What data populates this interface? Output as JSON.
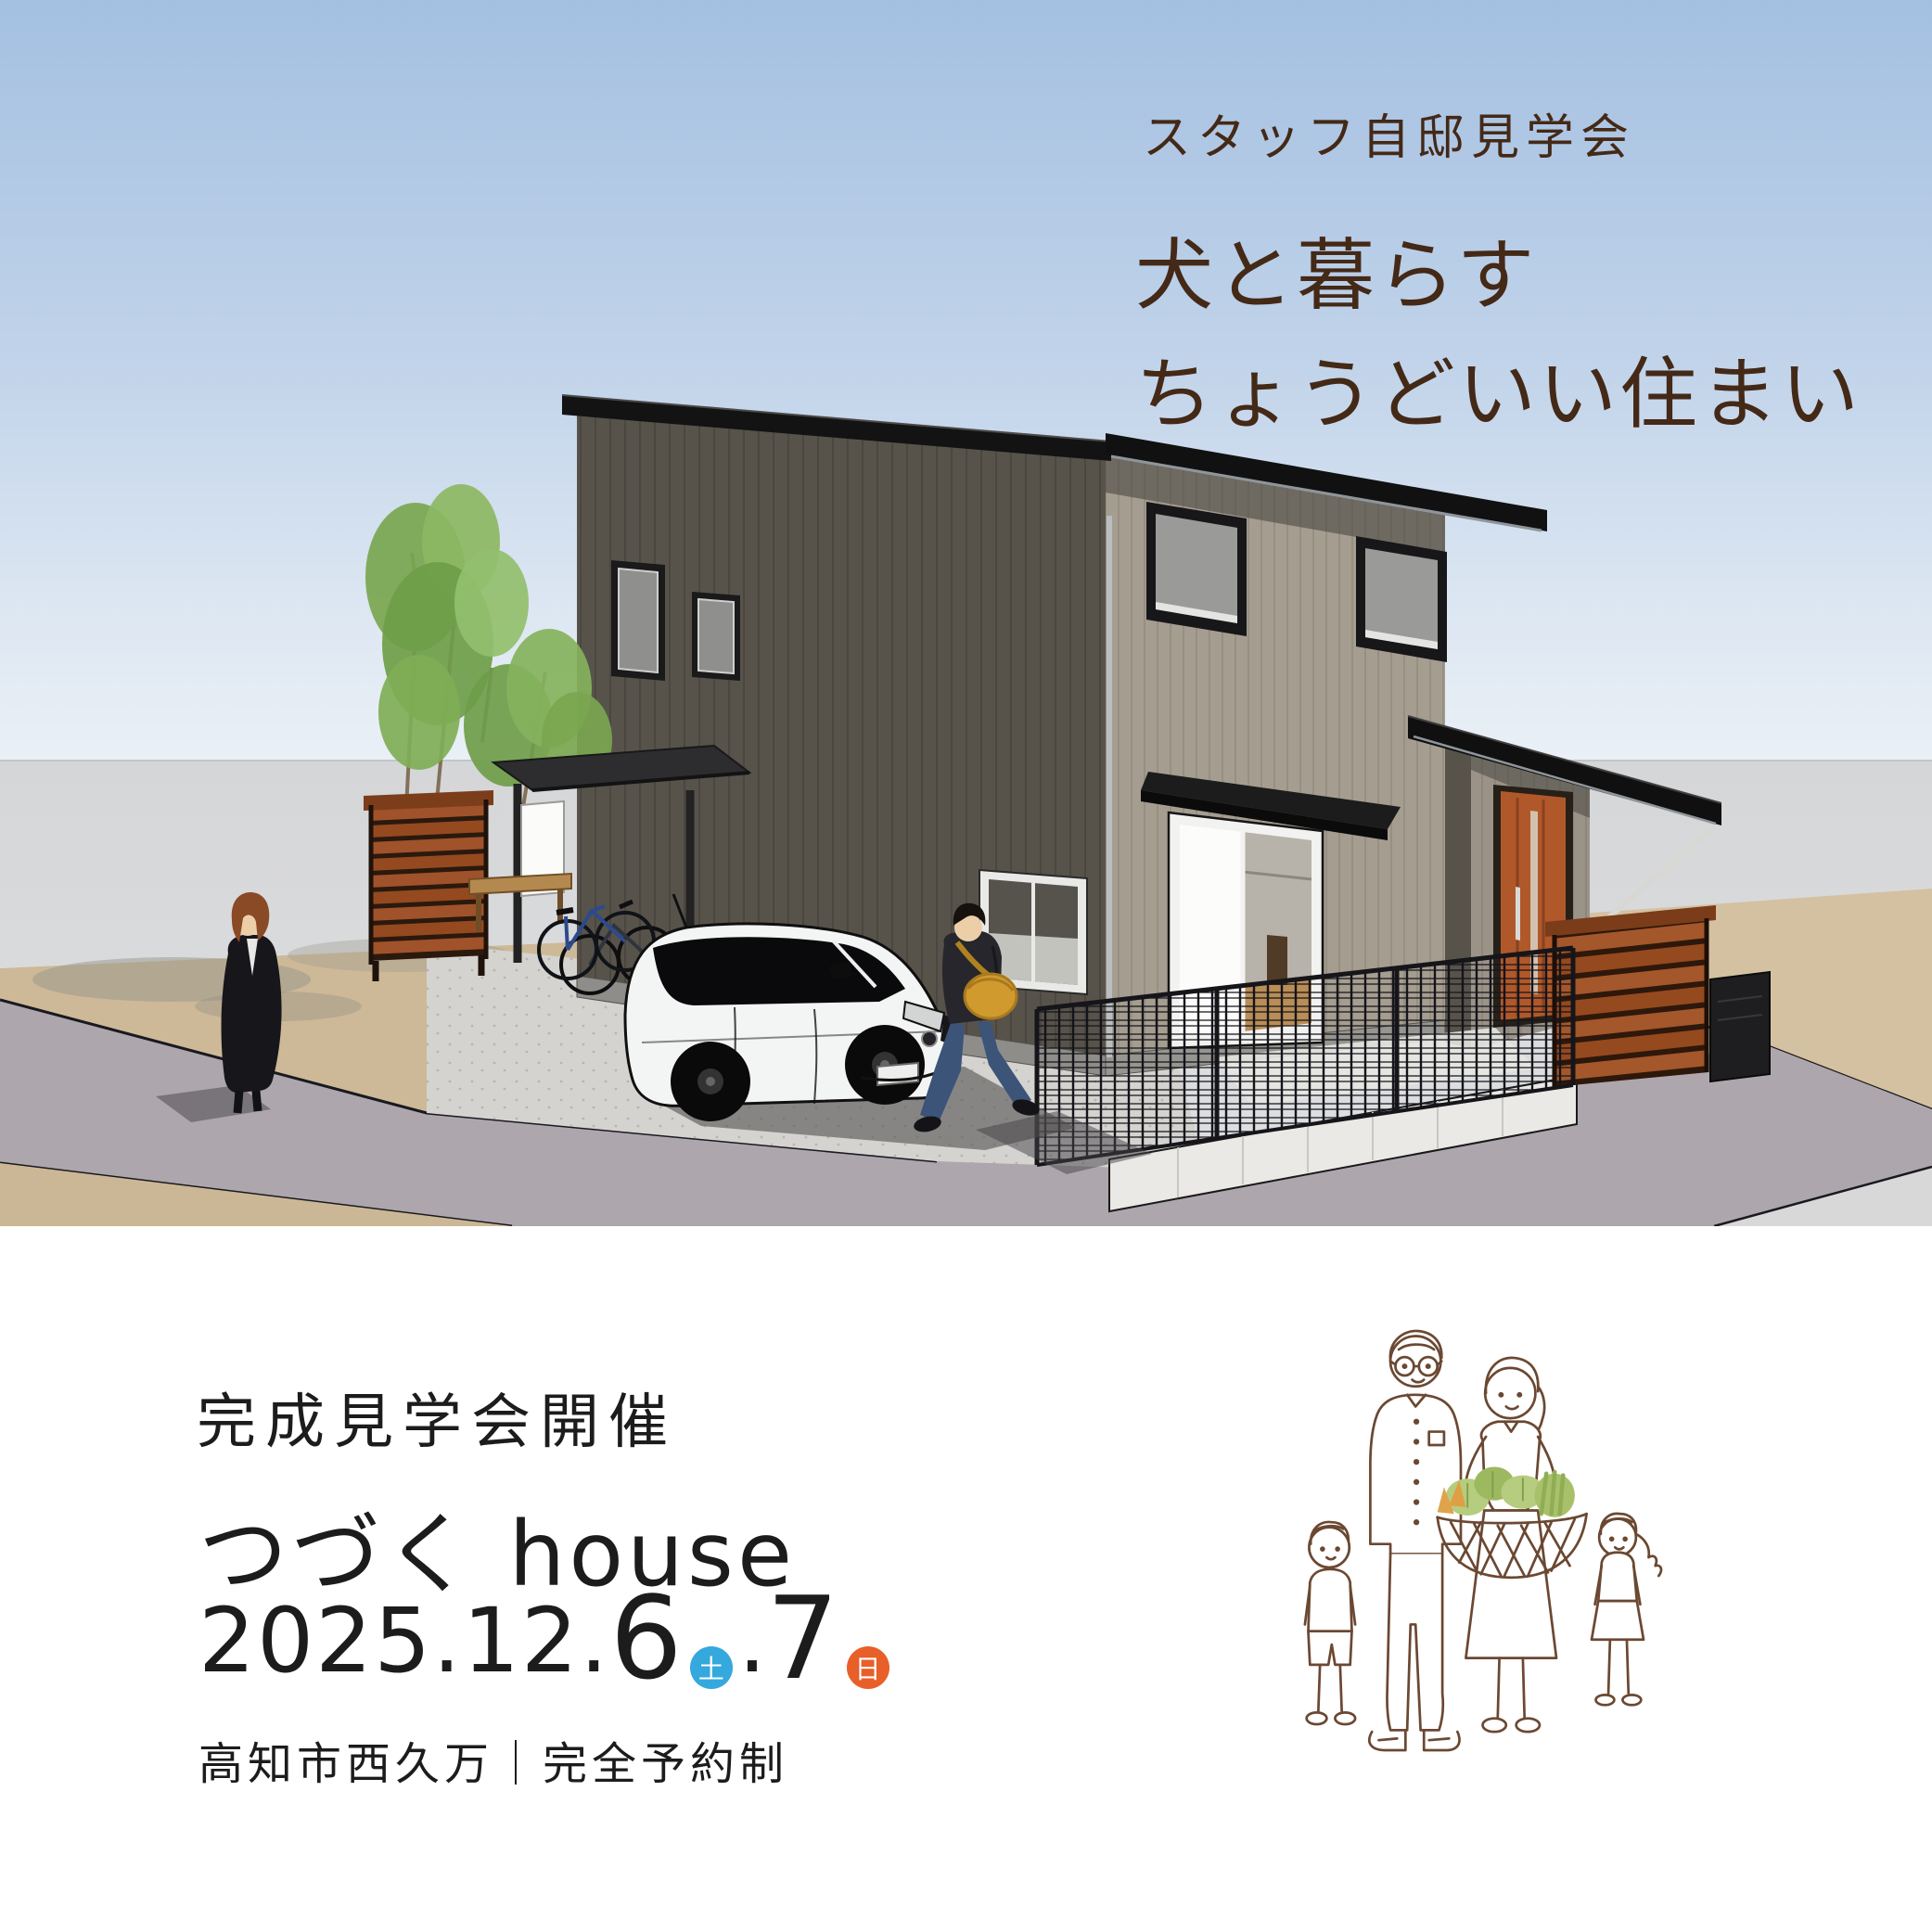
{
  "poster": {
    "hero": {
      "event_tag": "スタッフ自邸見学会",
      "headline_line1": "犬と暮らす",
      "headline_line2": "ちょうどいい住まい"
    },
    "details": {
      "subtitle": "完成見学会開催",
      "title": "つづく house",
      "date": {
        "year_month": "2025.12.",
        "day1_number": "6",
        "day1_week": "土",
        "separator": ".",
        "day2_number": "7",
        "day2_week": "日"
      },
      "venue": "高知市西久万｜完全予約制"
    },
    "colors": {
      "headline_brown": "#442917",
      "body_text_black": "#1c1c1c",
      "saturday_badge_blue": "#35a8dd",
      "sunday_badge_orange": "#e85f2a",
      "sky_blue_top": "#a4c0e1",
      "sky_blue_bottom": "#eaf0f6",
      "house_wall_dark": "#57534b",
      "house_wall_light": "#a59d90",
      "roof_black": "#131313",
      "wood_fence_brown": "#a3572b",
      "entrance_door_wood": "#b1582b",
      "road_gray": "#aea6ad",
      "dirt_tan": "#cdb997",
      "illustration_line_brown": "#6b4832",
      "vegetable_green": "#b6cc7e",
      "vegetable_orange": "#e0a34a"
    },
    "scene_alt": "3D exterior rendering of a two-story house with dark gray walls, black mono-pitched roofs, wooden entrance door, carport with bicycles, white compact car, wooden slat fences, trees and two pedestrians on the street",
    "family_alt": "hand-drawn family of four holding a basket of vegetables"
  }
}
